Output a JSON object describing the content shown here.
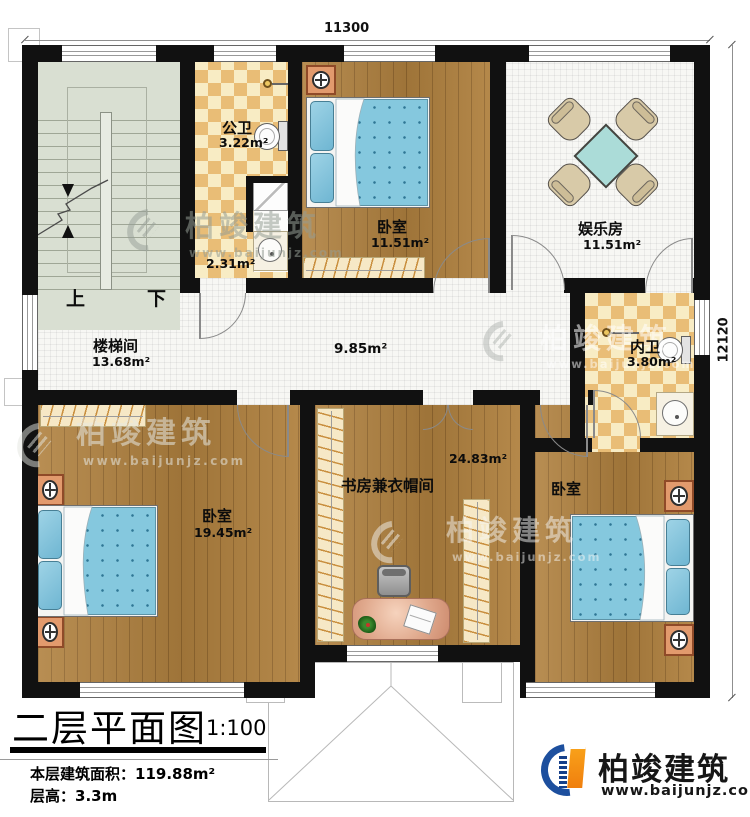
{
  "dimensions": {
    "top": "11300",
    "right": "12120"
  },
  "rooms": [
    {
      "id": "public-bath",
      "name": "公卫",
      "area": "3.22m²"
    },
    {
      "id": "small-bath",
      "name": "",
      "area": "2.31m²"
    },
    {
      "id": "bedroom-top",
      "name": "卧室",
      "area": "11.51m²"
    },
    {
      "id": "entertainment",
      "name": "娱乐房",
      "area": "11.51m²"
    },
    {
      "id": "stairwell",
      "name": "楼梯间",
      "area": "13.68m²"
    },
    {
      "id": "hall",
      "name": "",
      "area": "9.85m²"
    },
    {
      "id": "ensuite-bath",
      "name": "内卫",
      "area": "3.80m²"
    },
    {
      "id": "bedroom-left",
      "name": "卧室",
      "area": "19.45m²"
    },
    {
      "id": "study",
      "name": "书房兼衣帽间",
      "area": "24.83m²"
    },
    {
      "id": "bedroom-right",
      "name": "卧室",
      "area": ""
    }
  ],
  "stairs": {
    "up": "上",
    "down": "下"
  },
  "title_block": {
    "title": "二层平面图",
    "scale": "1:100",
    "area_label": "本层建筑面积：",
    "area_value": "119.88m²",
    "height_label": "层高：",
    "height_value": "3.3m"
  },
  "brand": {
    "name": "柏竣建筑",
    "website": "www.baijunjz.com"
  },
  "watermark": {
    "name": "柏竣建筑",
    "website": "www.baijunjz.com"
  },
  "colors": {
    "wall": "#111111",
    "wood": "#b0813f",
    "checker_dark": "#e9bd76",
    "checker_light": "#f8ecc4",
    "tile": "#f7f7f4",
    "stair": "#d9dfd2",
    "bed_blue": "#85c8de",
    "nightstand_orange": "#e29a6d",
    "table_teal": "#abdcd8",
    "logo_blue": "#1d4f9e",
    "logo_orange": "#f7941d"
  }
}
